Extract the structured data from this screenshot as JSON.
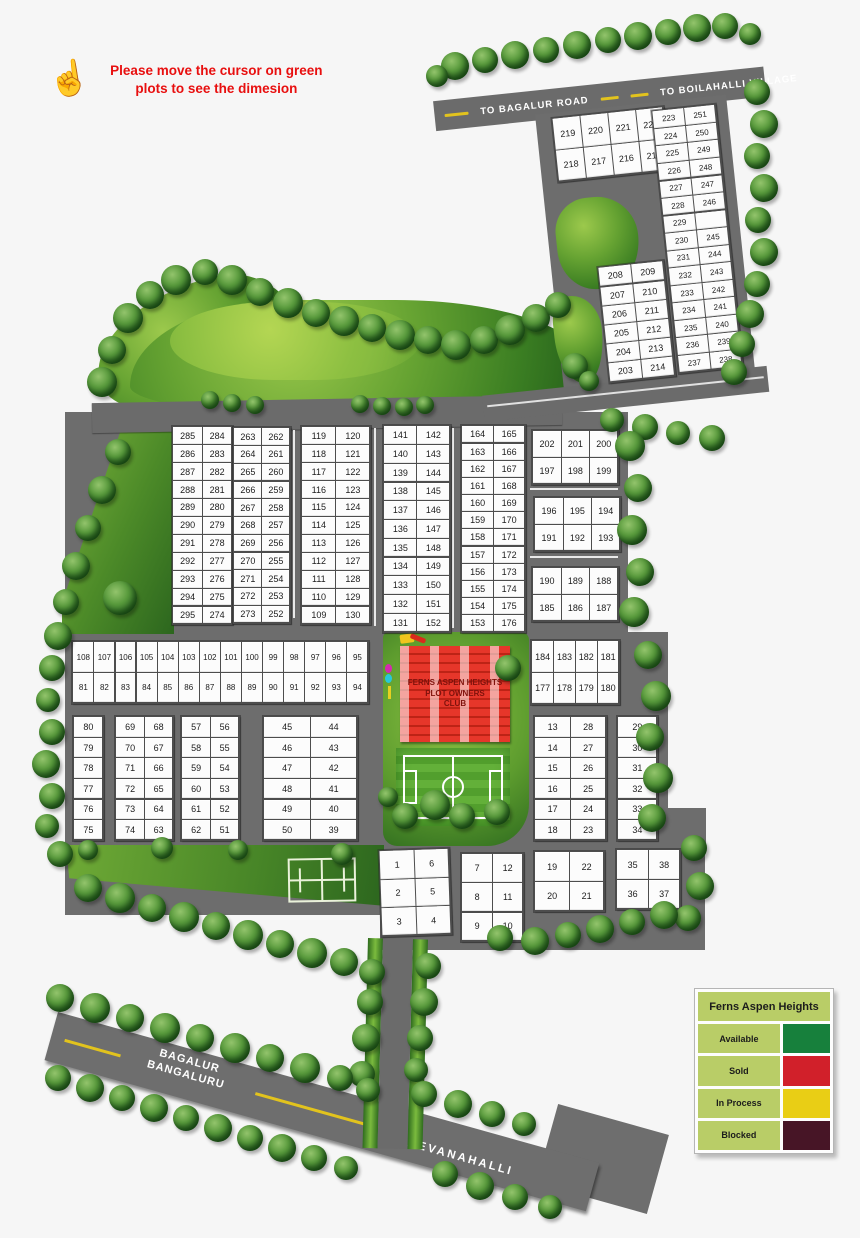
{
  "note": {
    "text": "Please move the cursor on green plots to see the dimesion"
  },
  "roads": {
    "to_bagalur": "TO BAGALUR ROAD",
    "to_boilahalli": "TO BOILAHALLI VILLAGE",
    "bagalur_line1": "BAGALUR",
    "bagalur_line2": "BANGALURU",
    "devanahalli": "DEVANAHALLI"
  },
  "club": {
    "line1": "FERNS ASPEN HEIGHTS",
    "line2": "PLOT OWNERS",
    "line3": "CLUB"
  },
  "legend": {
    "title": "Ferns Aspen Heights",
    "items": [
      {
        "label": "Available",
        "color": "#17803c"
      },
      {
        "label": "Sold",
        "color": "#d1202a"
      },
      {
        "label": "In Process",
        "color": "#e9ce15"
      },
      {
        "label": "Blocked",
        "color": "#471526"
      }
    ]
  },
  "blocks": [
    {
      "id": "219-215",
      "parent": "tr-blocks",
      "x": 104,
      "y": 29,
      "w": 110,
      "h": 62,
      "fs": 9,
      "rows": [
        [
          "219",
          "220",
          "221",
          "222"
        ],
        [
          "218",
          "217",
          "216",
          "215"
        ]
      ]
    },
    {
      "id": "223-251",
      "parent": "tr-blocks",
      "x": 204,
      "y": 32,
      "w": 62,
      "h": 262,
      "fs": 8,
      "rows": [
        [
          "223",
          "251"
        ],
        [
          "224",
          "250"
        ],
        [
          "225",
          "249"
        ],
        [
          "226",
          "248"
        ],
        [
          "227",
          "247"
        ],
        [
          "228",
          "246"
        ],
        [
          "229",
          ""
        ],
        [
          "230",
          "245"
        ],
        [
          "231",
          "244"
        ],
        [
          "232",
          "243"
        ],
        [
          "233",
          "242"
        ],
        [
          "234",
          "241"
        ],
        [
          "235",
          "240"
        ],
        [
          "236",
          "239"
        ],
        [
          "237",
          "238"
        ]
      ]
    },
    {
      "id": "208-214",
      "parent": "tr-blocks",
      "x": 134,
      "y": 182,
      "w": 64,
      "h": 114,
      "fs": 9,
      "rows": [
        [
          "208",
          "209"
        ],
        [
          "207",
          "210"
        ],
        [
          "206",
          "211"
        ],
        [
          "205",
          "212"
        ],
        [
          "204",
          "213"
        ],
        [
          "203",
          "214"
        ]
      ]
    },
    {
      "id": "285-274",
      "x": 172,
      "y": 426,
      "w": 58,
      "h": 196,
      "fs": 9,
      "rows": [
        [
          "285",
          "284"
        ],
        [
          "286",
          "283"
        ],
        [
          "287",
          "282"
        ],
        [
          "288",
          "281"
        ],
        [
          "289",
          "280"
        ],
        [
          "290",
          "279"
        ],
        [
          "291",
          "278"
        ],
        [
          "292",
          "277"
        ],
        [
          "293",
          "276"
        ],
        [
          "294",
          "275"
        ],
        [
          "295",
          "274"
        ]
      ]
    },
    {
      "id": "263-252",
      "x": 233,
      "y": 427,
      "w": 55,
      "h": 194,
      "fs": 9,
      "rows": [
        [
          "263",
          "262"
        ],
        [
          "264",
          "261"
        ],
        [
          "265",
          "260"
        ],
        [
          "266",
          "259"
        ],
        [
          "267",
          "258"
        ],
        [
          "268",
          "257"
        ],
        [
          "269",
          "256"
        ],
        [
          "270",
          "255"
        ],
        [
          "271",
          "254"
        ],
        [
          "272",
          "253"
        ],
        [
          "273",
          "252"
        ]
      ]
    },
    {
      "id": "119-130",
      "x": 301,
      "y": 426,
      "w": 67,
      "h": 196,
      "fs": 9,
      "rows": [
        [
          "119",
          "120"
        ],
        [
          "118",
          "121"
        ],
        [
          "117",
          "122"
        ],
        [
          "116",
          "123"
        ],
        [
          "115",
          "124"
        ],
        [
          "114",
          "125"
        ],
        [
          "113",
          "126"
        ],
        [
          "112",
          "127"
        ],
        [
          "111",
          "128"
        ],
        [
          "110",
          "129"
        ],
        [
          "109",
          "130"
        ]
      ]
    },
    {
      "id": "141-152",
      "x": 383,
      "y": 425,
      "w": 65,
      "h": 205,
      "fs": 9,
      "rows": [
        [
          "141",
          "142"
        ],
        [
          "140",
          "143"
        ],
        [
          "139",
          "144"
        ],
        [
          "138",
          "145"
        ],
        [
          "137",
          "146"
        ],
        [
          "136",
          "147"
        ],
        [
          "135",
          "148"
        ],
        [
          "134",
          "149"
        ],
        [
          "133",
          "150"
        ],
        [
          "132",
          "151"
        ],
        [
          "131",
          "152"
        ]
      ]
    },
    {
      "id": "164-176",
      "x": 461,
      "y": 425,
      "w": 62,
      "h": 205,
      "fs": 9,
      "rows": [
        [
          "164",
          "165"
        ],
        [
          "163",
          "166"
        ],
        [
          "162",
          "167"
        ],
        [
          "161",
          "168"
        ],
        [
          "160",
          "169"
        ],
        [
          "159",
          "170"
        ],
        [
          "158",
          "171"
        ],
        [
          "157",
          "172"
        ],
        [
          "156",
          "173"
        ],
        [
          "155",
          "174"
        ],
        [
          "154",
          "175"
        ],
        [
          "153",
          "176"
        ]
      ]
    },
    {
      "id": "202-199",
      "x": 532,
      "y": 430,
      "w": 84,
      "h": 52,
      "fs": 9,
      "rows": [
        [
          "202",
          "201",
          "200"
        ],
        [
          "197",
          "198",
          "199"
        ]
      ]
    },
    {
      "id": "196-193",
      "x": 534,
      "y": 497,
      "w": 84,
      "h": 52,
      "fs": 9,
      "rows": [
        [
          "196",
          "195",
          "194"
        ],
        [
          "191",
          "192",
          "193"
        ]
      ]
    },
    {
      "id": "190-187",
      "x": 532,
      "y": 567,
      "w": 84,
      "h": 52,
      "fs": 9,
      "rows": [
        [
          "190",
          "189",
          "188"
        ],
        [
          "185",
          "186",
          "187"
        ]
      ]
    },
    {
      "id": "108-94",
      "x": 72,
      "y": 641,
      "w": 294,
      "h": 60,
      "fs": 8,
      "rows": [
        [
          "108",
          "107",
          "106",
          "105",
          "104",
          "103",
          "102",
          "101",
          "100",
          "99",
          "98",
          "97",
          "96",
          "95"
        ],
        [
          "81",
          "82",
          "83",
          "84",
          "85",
          "86",
          "87",
          "88",
          "89",
          "90",
          "91",
          "92",
          "93",
          "94"
        ]
      ]
    },
    {
      "id": "184-180",
      "x": 531,
      "y": 640,
      "w": 86,
      "h": 62,
      "fs": 9,
      "rows": [
        [
          "184",
          "183",
          "182",
          "181"
        ],
        [
          "177",
          "178",
          "179",
          "180"
        ]
      ]
    },
    {
      "id": "80-75",
      "x": 73,
      "y": 716,
      "w": 28,
      "h": 122,
      "fs": 9,
      "rows": [
        [
          "80"
        ],
        [
          "79"
        ],
        [
          "78"
        ],
        [
          "77"
        ],
        [
          "76"
        ],
        [
          "75"
        ]
      ]
    },
    {
      "id": "69-63",
      "x": 115,
      "y": 716,
      "w": 56,
      "h": 122,
      "fs": 9,
      "rows": [
        [
          "69",
          "68"
        ],
        [
          "70",
          "67"
        ],
        [
          "71",
          "66"
        ],
        [
          "72",
          "65"
        ],
        [
          "73",
          "64"
        ],
        [
          "74",
          "63"
        ]
      ]
    },
    {
      "id": "57-51",
      "x": 181,
      "y": 716,
      "w": 56,
      "h": 122,
      "fs": 9,
      "rows": [
        [
          "57",
          "56"
        ],
        [
          "58",
          "55"
        ],
        [
          "59",
          "54"
        ],
        [
          "60",
          "53"
        ],
        [
          "61",
          "52"
        ],
        [
          "62",
          "51"
        ]
      ]
    },
    {
      "id": "45-39",
      "x": 263,
      "y": 716,
      "w": 92,
      "h": 122,
      "fs": 9,
      "rows": [
        [
          "45",
          "44"
        ],
        [
          "46",
          "43"
        ],
        [
          "47",
          "42"
        ],
        [
          "48",
          "41"
        ],
        [
          "49",
          "40"
        ],
        [
          "50",
          "39"
        ]
      ]
    },
    {
      "id": "13-23",
      "x": 534,
      "y": 716,
      "w": 70,
      "h": 122,
      "fs": 9,
      "rows": [
        [
          "13",
          "28"
        ],
        [
          "14",
          "27"
        ],
        [
          "15",
          "26"
        ],
        [
          "16",
          "25"
        ],
        [
          "17",
          "24"
        ],
        [
          "18",
          "23"
        ]
      ]
    },
    {
      "id": "29-34",
      "x": 617,
      "y": 716,
      "w": 38,
      "h": 122,
      "fs": 9,
      "rows": [
        [
          "29"
        ],
        [
          "30"
        ],
        [
          "31"
        ],
        [
          "32"
        ],
        [
          "33"
        ],
        [
          "34"
        ]
      ]
    },
    {
      "id": "1-4",
      "x": 380,
      "y": 849,
      "w": 68,
      "h": 84,
      "fs": 9,
      "rot": -2,
      "rows": [
        [
          "1",
          "6"
        ],
        [
          "2",
          "5"
        ],
        [
          "3",
          "4"
        ]
      ]
    },
    {
      "id": "7-10",
      "x": 461,
      "y": 853,
      "w": 60,
      "h": 86,
      "fs": 9,
      "rows": [
        [
          "7",
          "12"
        ],
        [
          "8",
          "11"
        ],
        [
          "9",
          "10"
        ]
      ]
    },
    {
      "id": "19-21",
      "x": 534,
      "y": 851,
      "w": 68,
      "h": 58,
      "fs": 9,
      "rows": [
        [
          "19",
          "22"
        ],
        [
          "20",
          "21"
        ]
      ]
    },
    {
      "id": "35-37",
      "x": 616,
      "y": 849,
      "w": 62,
      "h": 58,
      "fs": 9,
      "rows": [
        [
          "35",
          "38"
        ],
        [
          "36",
          "37"
        ]
      ]
    }
  ],
  "trees": [
    [
      455,
      66,
      28,
      0
    ],
    [
      485,
      60,
      26,
      0
    ],
    [
      515,
      55,
      28,
      0
    ],
    [
      546,
      50,
      26,
      0
    ],
    [
      577,
      45,
      28,
      0
    ],
    [
      608,
      40,
      26,
      0
    ],
    [
      638,
      36,
      28,
      0
    ],
    [
      668,
      32,
      26,
      0
    ],
    [
      697,
      28,
      28,
      0
    ],
    [
      725,
      26,
      26,
      0
    ],
    [
      750,
      34,
      22,
      0
    ],
    [
      437,
      76,
      22,
      0
    ],
    [
      757,
      92,
      26,
      0
    ],
    [
      764,
      124,
      28,
      0
    ],
    [
      757,
      156,
      26,
      0
    ],
    [
      764,
      188,
      28,
      0
    ],
    [
      758,
      220,
      26,
      0
    ],
    [
      764,
      252,
      28,
      0
    ],
    [
      757,
      284,
      26,
      0
    ],
    [
      750,
      314,
      28,
      0
    ],
    [
      742,
      344,
      26,
      0
    ],
    [
      734,
      372,
      26,
      0
    ],
    [
      575,
      366,
      26,
      1
    ],
    [
      589,
      381,
      20,
      1
    ],
    [
      102,
      382,
      30,
      0
    ],
    [
      112,
      350,
      28,
      0
    ],
    [
      128,
      318,
      30,
      0
    ],
    [
      150,
      295,
      28,
      0
    ],
    [
      176,
      280,
      30,
      0
    ],
    [
      205,
      272,
      26,
      0
    ],
    [
      232,
      280,
      30,
      0
    ],
    [
      260,
      292,
      28,
      0
    ],
    [
      288,
      303,
      30,
      0
    ],
    [
      316,
      313,
      28,
      0
    ],
    [
      344,
      321,
      30,
      0
    ],
    [
      372,
      328,
      28,
      0
    ],
    [
      400,
      335,
      30,
      0
    ],
    [
      428,
      340,
      28,
      0
    ],
    [
      456,
      345,
      30,
      0
    ],
    [
      484,
      340,
      28,
      0
    ],
    [
      510,
      330,
      30,
      0
    ],
    [
      536,
      318,
      28,
      0
    ],
    [
      558,
      305,
      26,
      0
    ],
    [
      210,
      400,
      18,
      0
    ],
    [
      232,
      403,
      18,
      0
    ],
    [
      255,
      405,
      18,
      0
    ],
    [
      360,
      404,
      18,
      0
    ],
    [
      382,
      406,
      18,
      0
    ],
    [
      404,
      407,
      18,
      0
    ],
    [
      425,
      405,
      18,
      0
    ],
    [
      612,
      420,
      24,
      0
    ],
    [
      645,
      427,
      26,
      0
    ],
    [
      678,
      433,
      24,
      0
    ],
    [
      712,
      438,
      26,
      0
    ],
    [
      630,
      446,
      30,
      0
    ],
    [
      638,
      488,
      28,
      0
    ],
    [
      632,
      530,
      30,
      0
    ],
    [
      640,
      572,
      28,
      0
    ],
    [
      634,
      612,
      30,
      0
    ],
    [
      648,
      655,
      28,
      0
    ],
    [
      656,
      696,
      30,
      0
    ],
    [
      650,
      737,
      28,
      0
    ],
    [
      658,
      778,
      30,
      0
    ],
    [
      652,
      818,
      28,
      0
    ],
    [
      694,
      848,
      26,
      0
    ],
    [
      700,
      886,
      28,
      0
    ],
    [
      688,
      918,
      26,
      0
    ],
    [
      500,
      938,
      26,
      0
    ],
    [
      535,
      941,
      28,
      0
    ],
    [
      568,
      935,
      26,
      0
    ],
    [
      600,
      929,
      28,
      0
    ],
    [
      632,
      922,
      26,
      0
    ],
    [
      664,
      915,
      28,
      0
    ],
    [
      118,
      452,
      26,
      0
    ],
    [
      102,
      490,
      28,
      0
    ],
    [
      88,
      528,
      26,
      0
    ],
    [
      76,
      566,
      28,
      0
    ],
    [
      66,
      602,
      26,
      0
    ],
    [
      58,
      636,
      28,
      0
    ],
    [
      52,
      668,
      26,
      0
    ],
    [
      48,
      700,
      24,
      0
    ],
    [
      52,
      732,
      26,
      0
    ],
    [
      46,
      764,
      28,
      0
    ],
    [
      52,
      796,
      26,
      0
    ],
    [
      47,
      826,
      24,
      0
    ],
    [
      60,
      854,
      26,
      0
    ],
    [
      120,
      598,
      34,
      1
    ],
    [
      88,
      850,
      20,
      0
    ],
    [
      162,
      848,
      22,
      0
    ],
    [
      238,
      850,
      20,
      0
    ],
    [
      342,
      854,
      22,
      0
    ],
    [
      88,
      888,
      28,
      0
    ],
    [
      120,
      898,
      30,
      0
    ],
    [
      152,
      908,
      28,
      0
    ],
    [
      184,
      917,
      30,
      0
    ],
    [
      216,
      926,
      28,
      0
    ],
    [
      248,
      935,
      30,
      0
    ],
    [
      280,
      944,
      28,
      0
    ],
    [
      312,
      953,
      30,
      0
    ],
    [
      344,
      962,
      28,
      0
    ],
    [
      372,
      972,
      26,
      0
    ],
    [
      370,
      1002,
      26,
      0
    ],
    [
      366,
      1038,
      28,
      0
    ],
    [
      362,
      1074,
      26,
      0
    ],
    [
      428,
      966,
      26,
      0
    ],
    [
      424,
      1002,
      28,
      0
    ],
    [
      420,
      1038,
      26,
      0
    ],
    [
      416,
      1070,
      24,
      0
    ],
    [
      60,
      998,
      28,
      0
    ],
    [
      95,
      1008,
      30,
      0
    ],
    [
      130,
      1018,
      28,
      0
    ],
    [
      165,
      1028,
      30,
      0
    ],
    [
      200,
      1038,
      28,
      0
    ],
    [
      235,
      1048,
      30,
      0
    ],
    [
      270,
      1058,
      28,
      0
    ],
    [
      305,
      1068,
      30,
      0
    ],
    [
      340,
      1078,
      26,
      0
    ],
    [
      368,
      1090,
      24,
      0
    ],
    [
      424,
      1094,
      26,
      0
    ],
    [
      458,
      1104,
      28,
      0
    ],
    [
      492,
      1114,
      26,
      0
    ],
    [
      524,
      1124,
      24,
      0
    ],
    [
      58,
      1078,
      26,
      0
    ],
    [
      90,
      1088,
      28,
      0
    ],
    [
      122,
      1098,
      26,
      0
    ],
    [
      154,
      1108,
      28,
      0
    ],
    [
      186,
      1118,
      26,
      0
    ],
    [
      218,
      1128,
      28,
      0
    ],
    [
      250,
      1138,
      26,
      0
    ],
    [
      282,
      1148,
      28,
      0
    ],
    [
      314,
      1158,
      26,
      0
    ],
    [
      346,
      1168,
      24,
      0
    ],
    [
      445,
      1174,
      26,
      0
    ],
    [
      480,
      1186,
      28,
      0
    ],
    [
      515,
      1197,
      26,
      0
    ],
    [
      550,
      1207,
      24,
      0
    ],
    [
      405,
      816,
      26,
      1
    ],
    [
      435,
      805,
      30,
      0
    ],
    [
      462,
      816,
      26,
      0
    ],
    [
      497,
      812,
      26,
      0
    ],
    [
      388,
      797,
      20,
      0
    ],
    [
      508,
      668,
      26,
      0
    ]
  ]
}
